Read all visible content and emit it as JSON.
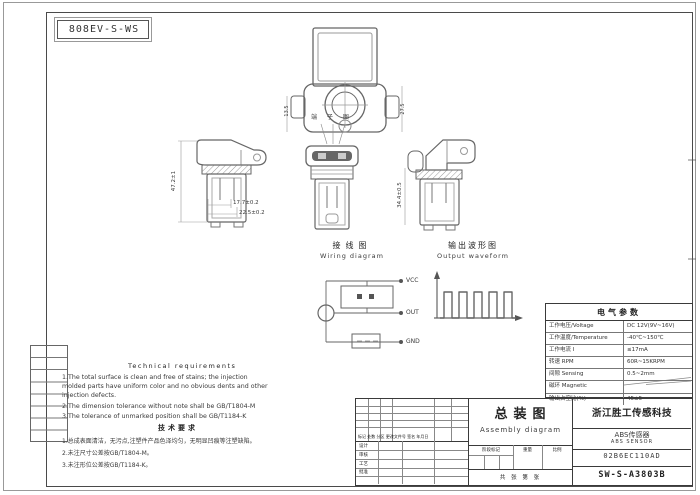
{
  "sheet": {
    "code_box": "808EV-S-WS"
  },
  "views": {
    "top": {
      "dim_left": "13.5",
      "dim_right": "27.5",
      "pin_label": "端 子 图"
    },
    "left": {
      "dim_height": "47.2±1",
      "dim_w1": "17.7±0.2",
      "dim_w2": "22.5±0.2"
    },
    "right": {
      "dim_height": "34.4±0.5"
    }
  },
  "wiring": {
    "title_zh": "接线图",
    "title_en": "Wiring diagram",
    "terminals": [
      "VCC",
      "OUT",
      "GND"
    ]
  },
  "waveform": {
    "title_zh": "输出波形图",
    "title_en": "Output waveform"
  },
  "electrical": {
    "title": "电气参数",
    "rows": [
      {
        "label": "工作电压/Voltage",
        "value": "DC 12V(9V~16V)"
      },
      {
        "label": "工作温度/Temperature",
        "value": "-40℃~150℃"
      },
      {
        "label": "工作电流 I",
        "value": "≤17mA"
      },
      {
        "label": "转速 RPM",
        "value": "60R~15KRPM"
      },
      {
        "label": "间隙 Sensing",
        "value": "0.5~2mm"
      },
      {
        "label": "磁环 Magnetic",
        "value": ""
      },
      {
        "label": "输出占空比(%)",
        "value": "45±5"
      }
    ]
  },
  "tech": {
    "heading_en": "Technical requirements",
    "en1": "1.The total surface is clean and free of stains; the injection",
    "en2": "molded parts have uniform color and no obvious dents and other",
    "en3": "injection defects.",
    "en4": "2.The dimension tolerance without note shall be GB/T1804-M",
    "en5": "3.The tolerance of unmarked position shall be GB/T1184-K",
    "heading_zh": "技术要求",
    "zh1": "1.总成表面清洁，无污点,注塑件产品色泽均匀，无明显凹痕等注塑缺陷。",
    "zh2": "2.未注尺寸公差按GB/T1804-M。",
    "zh3": "3.未注形位公差按GB/T1184-K。"
  },
  "titleblock": {
    "title_zh": "总装图",
    "title_en": "Assembly diagram",
    "company": "浙江胜工传感科技",
    "product_zh": "ABS传感器",
    "product_en": "ABS SENSOR",
    "part_code": "02B6EC110AD",
    "drawing_no": "SW-S-A3803B",
    "rev_header": "标记 处数 分区 更改文件号 签名 年月日",
    "sig_design": "设计",
    "sig_check": "审核",
    "sig_process": "工艺",
    "sig_approve": "批准",
    "stage": "阶段标记",
    "weight": "重量",
    "scale": "比例",
    "sheets": "共 张 第 张"
  },
  "colors": {
    "line": "#666666",
    "frame": "#4a4a4a",
    "text": "#333333"
  }
}
